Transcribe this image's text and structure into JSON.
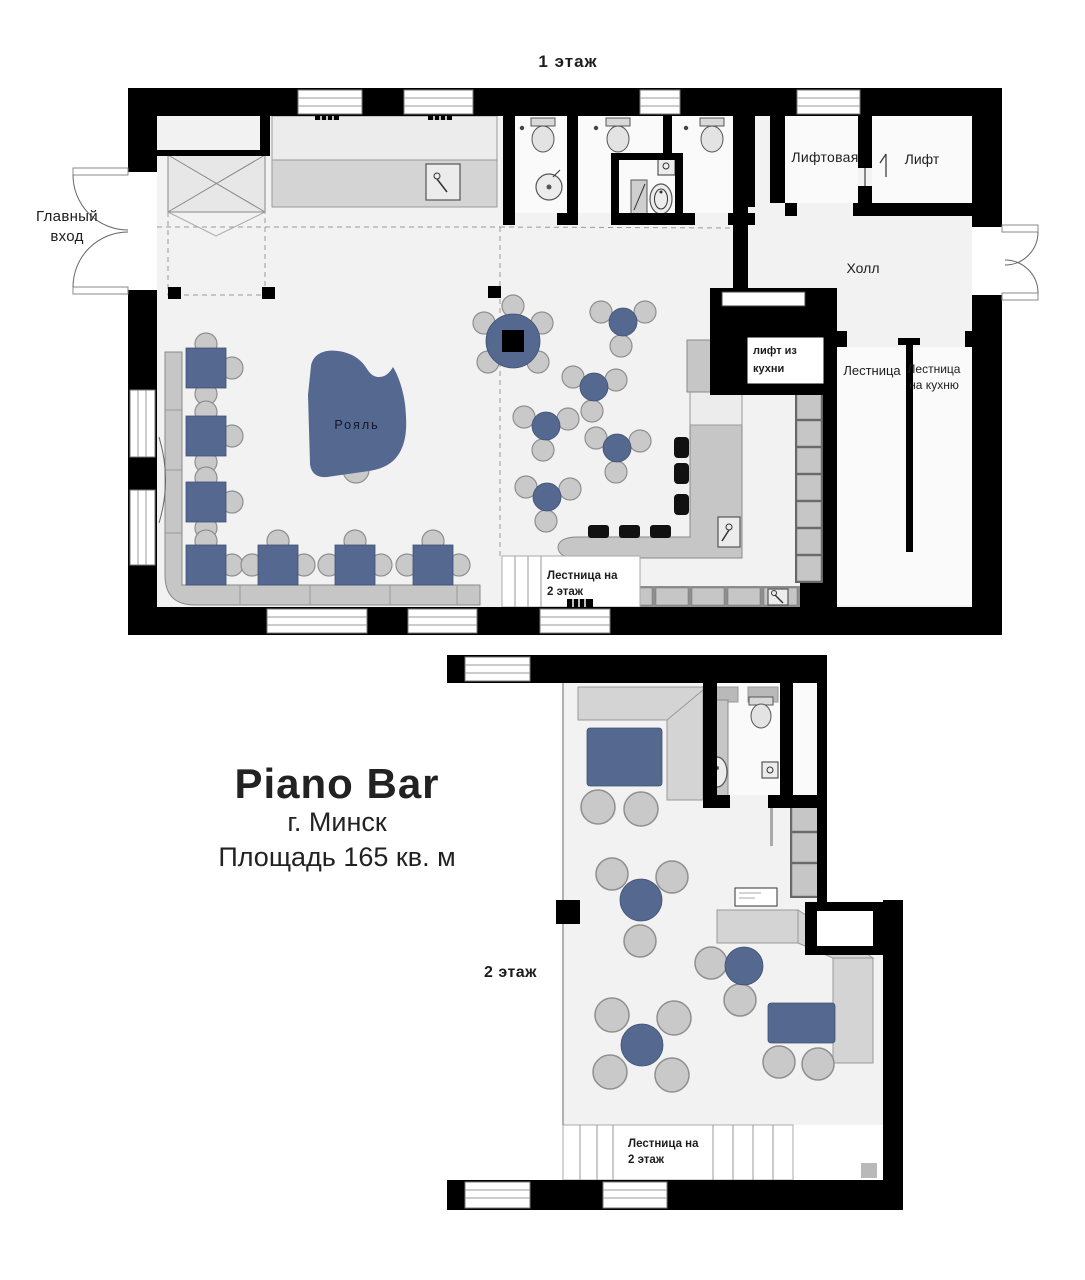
{
  "colors": {
    "accent_blue": "#546890",
    "wall_black": "#000000",
    "floor_gray": "#f2f2f2",
    "furniture_gray": "#c6c6c6",
    "sofa_gray": "#d4d4d4"
  },
  "floor1": {
    "title": "1 этаж",
    "labels": {
      "main_entrance": "Главный вход",
      "elevator_lobby": "Лифтовая",
      "elevator": "Лифт",
      "hall": "Холл",
      "kitchen_lift": "лифт из кухни",
      "stairs": "Лестница",
      "stairs_to_kitchen": "Лестница на кухню",
      "grand_piano": "Рояль",
      "stairs_to_floor2": "Лестница на 2 этаж"
    }
  },
  "floor2": {
    "title": "2 этаж",
    "labels": {
      "stairs_to_floor2": "Лестница на 2 этаж"
    }
  },
  "info_block": {
    "name": "Piano Bar",
    "city": "г. Минск",
    "area": "Площадь 165 кв. м"
  }
}
